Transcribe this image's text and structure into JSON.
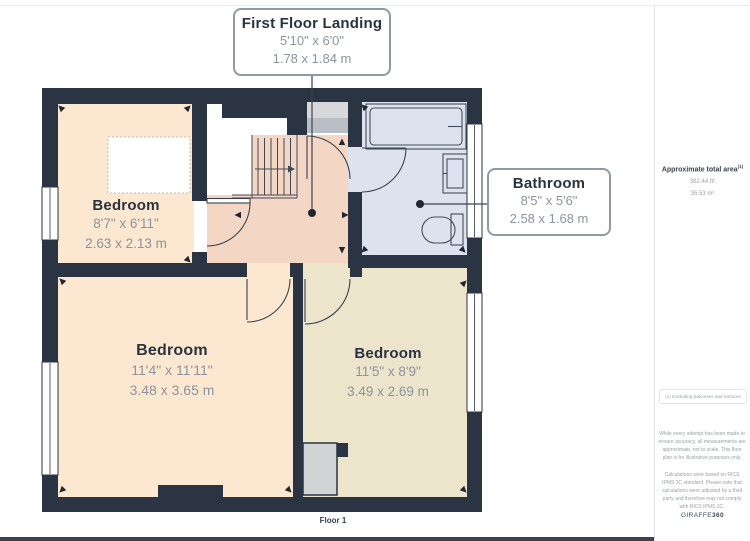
{
  "page": {
    "floor_label": "Floor 1"
  },
  "callouts": {
    "landing": {
      "title": "First Floor Landing",
      "imperial": "5'10\" x 6'0\"",
      "metric": "1.78 x 1.84 m"
    },
    "bathroom": {
      "title": "Bathroom",
      "imperial": "8'5\" x 5'6\"",
      "metric": "2.58 x 1.68 m"
    }
  },
  "rooms": {
    "bedroom_top_left": {
      "name": "Bedroom",
      "imperial": "8'7\" x 6'11\"",
      "metric": "2.63 x 2.13 m"
    },
    "bedroom_bottom_left": {
      "name": "Bedroom",
      "imperial": "11'4\" x 11'11\"",
      "metric": "3.48 x 3.65 m"
    },
    "bedroom_bottom_right": {
      "name": "Bedroom",
      "imperial": "11'5\" x 8'9\"",
      "metric": "3.49 x 2.69 m"
    }
  },
  "sidebar": {
    "area_title": "Approximate total area",
    "area_sup": "(1)",
    "area_ft": "382.44 ft²",
    "area_m": "35.53 m²",
    "note": "(1) Excluding balconies and terraces",
    "disclaimer1": "While every attempt has been made to ensure accuracy, all measurements are approximate, not to scale. This floor plan is for illustrative purposes only.",
    "disclaimer2": "Calculations were based on RICS IPMS 3C standard. Please note that calculations were adjusted by a third party and therefore may not comply with RICS IPMS 3C.",
    "brand": "GIRAFFE",
    "brand_bold": "360"
  },
  "colors": {
    "wall": "#2a3442",
    "bedroom_fill": "#fce8d0",
    "bedroom_alt_fill": "#ece5cc",
    "landing_fill": "#f4d6c4",
    "bathroom_fill": "#dde3ee",
    "cupboard_fill": "#c6cad1",
    "chimney_fill": "#d2d3d4",
    "text_dark": "#2b3240",
    "text_gray": "#8d939d"
  }
}
